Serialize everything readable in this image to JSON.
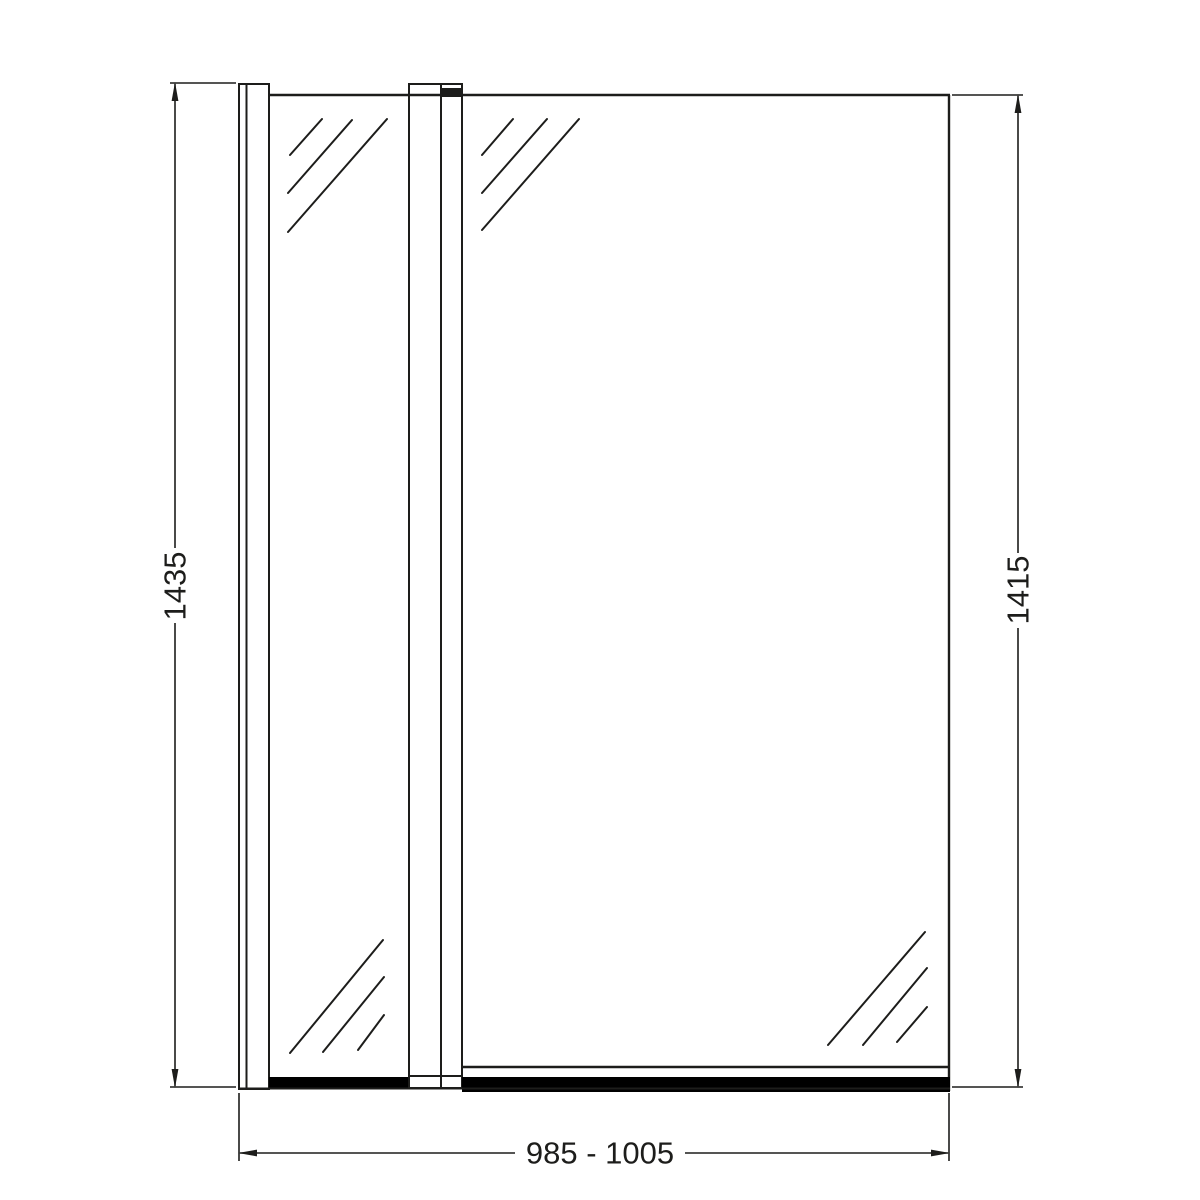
{
  "drawing": {
    "type": "technical-elevation-diagram",
    "subject": "hinged-bath-shower-screen-with-fixed-panel",
    "colors": {
      "line": "#1d1d1b",
      "seal": "#000000",
      "background": "#ffffff"
    },
    "dimensions": {
      "left_height": {
        "label": "1435",
        "orientation": "vertical"
      },
      "right_height": {
        "label": "1415",
        "orientation": "vertical"
      },
      "bottom_width": {
        "label": "985 - 1005",
        "orientation": "horizontal"
      }
    }
  }
}
